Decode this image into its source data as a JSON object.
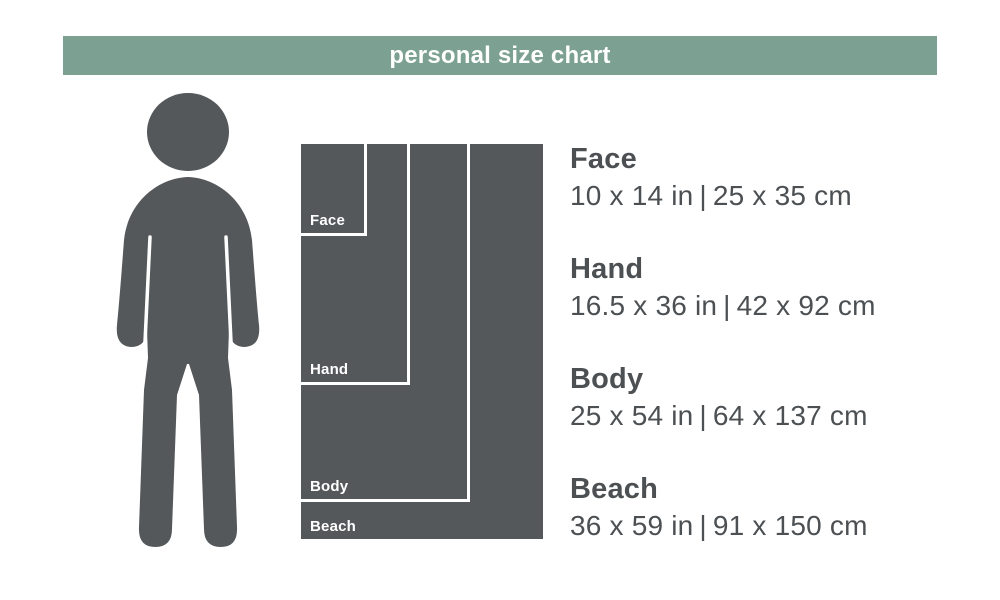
{
  "header": {
    "title": "personal size chart",
    "bg_color": "#7CA193",
    "text_color": "#ffffff"
  },
  "colors": {
    "silhouette_dark": "#54585B",
    "text_dark": "#4C5053",
    "divider_white": "#ffffff"
  },
  "figure": {
    "description": "person-silhouette"
  },
  "towel_chart": {
    "towels": [
      {
        "id": "face",
        "label": "Face"
      },
      {
        "id": "hand",
        "label": "Hand"
      },
      {
        "id": "body",
        "label": "Body"
      },
      {
        "id": "beach",
        "label": "Beach"
      }
    ]
  },
  "sizes": [
    {
      "name": "Face",
      "inches": "10 x 14 in",
      "separator": "|",
      "cm": "25 x 35 cm"
    },
    {
      "name": "Hand",
      "inches": "16.5 x 36 in",
      "separator": "|",
      "cm": "42 x 92 cm"
    },
    {
      "name": "Body",
      "inches": "25 x 54 in",
      "separator": "|",
      "cm": "64 x 137 cm"
    },
    {
      "name": "Beach",
      "inches": "36 x 59 in",
      "separator": "|",
      "cm": "91 x 150 cm"
    }
  ]
}
